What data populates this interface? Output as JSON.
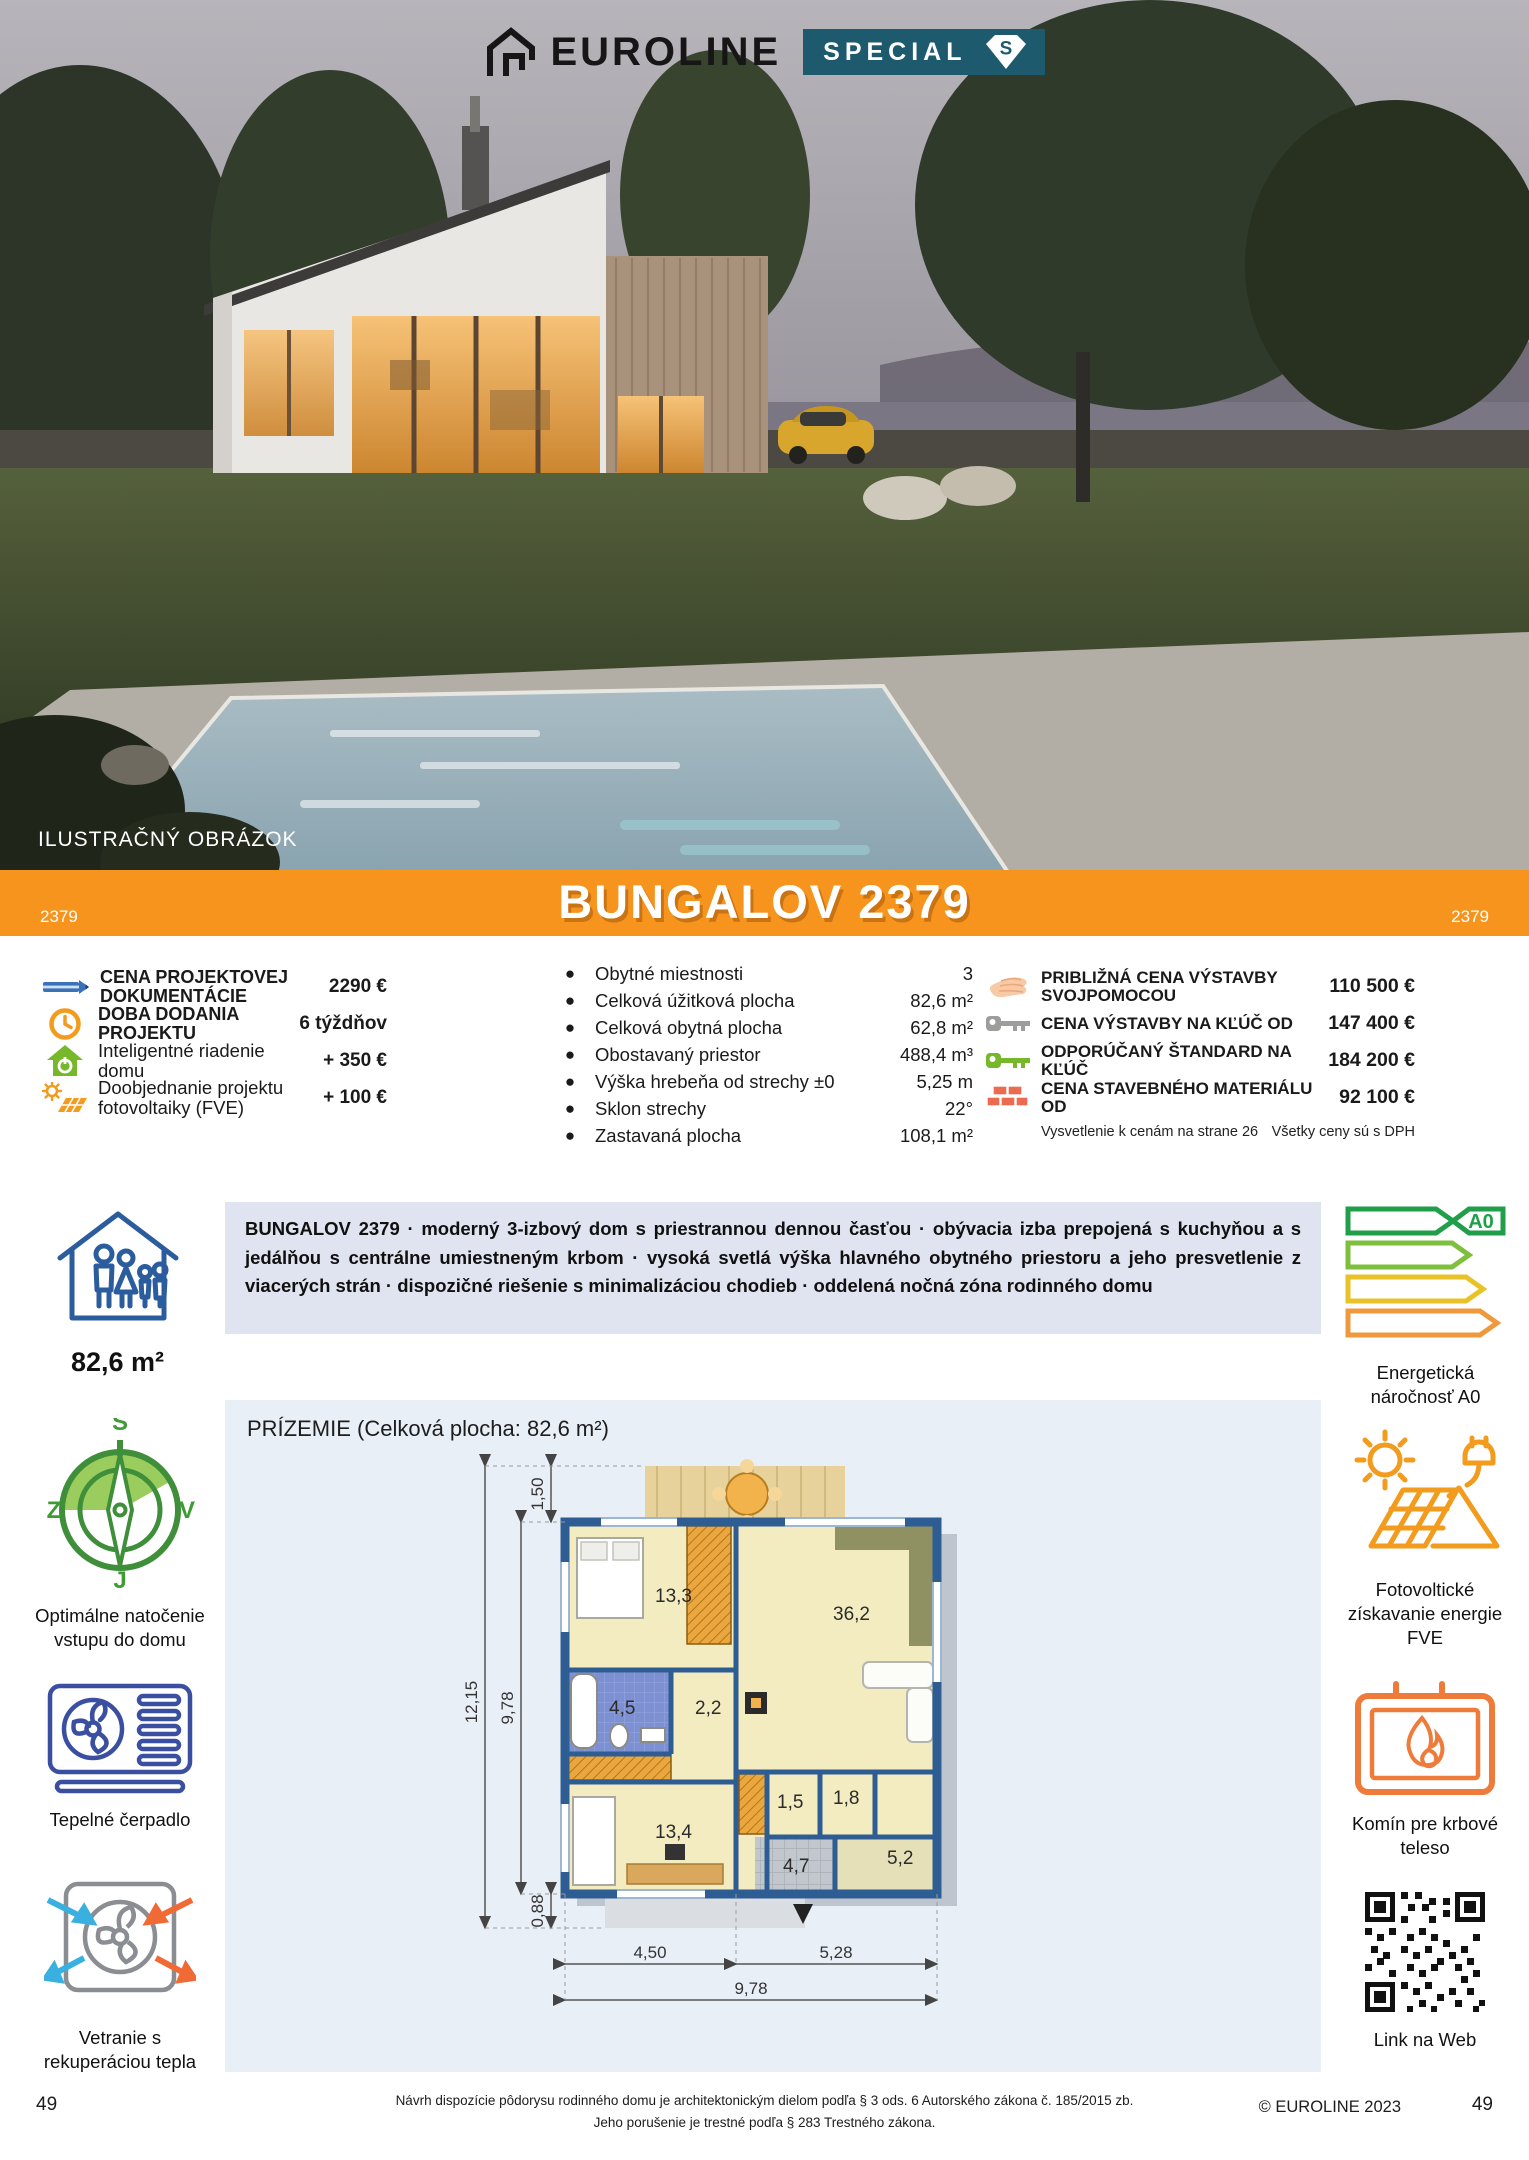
{
  "colors": {
    "accent_orange": "#f7941e",
    "badge_teal": "#1d5a6e",
    "desc_bg": "#dfe4f0",
    "plan_bg": "#e9eff7",
    "icon_blue": "#2b5d9e",
    "icon_green": "#76b82a"
  },
  "header": {
    "brand": "EUROLINE",
    "badge": "SPECIAL",
    "badge_monogram": "S",
    "photo_caption": "ILUSTRAČNÝ OBRÁZOK"
  },
  "banner": {
    "code_left": "2379",
    "title": "BUNGALOV 2379",
    "code_right": "2379"
  },
  "info": {
    "left": [
      {
        "icon": "pencil-icon",
        "label": "CENA PROJEKTOVEJ DOKUMENTÁCIE",
        "value": "2290 €"
      },
      {
        "icon": "clock-icon",
        "label": "DOBA DODANIA PROJEKTU",
        "value": "6 týždňov"
      },
      {
        "icon": "smart-home-icon",
        "label": "Inteligentné riadenie domu",
        "value": "+ 350 €"
      },
      {
        "icon": "solar-panel-icon",
        "label": "Doobjednanie projektu fotovoltaiky (FVE)",
        "value": "+ 100 €"
      }
    ],
    "params": [
      {
        "label": "Obytné miestnosti",
        "value": "3"
      },
      {
        "label": "Celková úžitková plocha",
        "value": "82,6 m²"
      },
      {
        "label": "Celková obytná plocha",
        "value": "62,8 m²"
      },
      {
        "label": "Obostavaný priestor",
        "value": "488,4 m³"
      },
      {
        "label": "Výška hrebeňa od strechy ±0",
        "value": "5,25 m"
      },
      {
        "label": "Sklon strechy",
        "value": "22°"
      },
      {
        "label": "Zastavaná plocha",
        "value": "108,1 m²"
      }
    ],
    "prices": [
      {
        "icon": "hand-icon",
        "label": "PRIBLIŽNÁ CENA VÝSTAVBY SVOJPOMOCOU",
        "value": "110 500 €"
      },
      {
        "icon": "key-gray-icon",
        "label": "CENA VÝSTAVBY NA KĽÚČ OD",
        "value": "147 400 €"
      },
      {
        "icon": "key-green-icon",
        "label": "ODPORÚČANÝ ŠTANDARD NA KĽÚČ",
        "value": "184 200 €"
      },
      {
        "icon": "bricks-icon",
        "label": "CENA STAVEBNÉHO MATERIÁLU OD",
        "value": "92 100 €"
      }
    ],
    "footnote_left": "Vysvetlenie k cenám na strane 26",
    "footnote_right": "Všetky ceny sú s DPH"
  },
  "summary": {
    "area": "82,6 m²",
    "description": "BUNGALOV 2379 · moderný 3-izbový dom s priestrannou dennou časťou · obývacia izba prepojená s kuchyňou a s jedálňou s centrálne umiestneným krbom · vysoká svetlá výška hlavného obytného priestoru a jeho presvetlenie z viacerých strán · dispozičné riešenie s minimalizáciou chodieb · oddelená nočná zóna rodinného domu",
    "energy_label": "A0",
    "energy_caption_line1": "Energetická",
    "energy_caption_line2": "náročnosť A0"
  },
  "features_left": [
    {
      "icon": "compass-icon",
      "caption": "Optimálne natočenie vstupu do domu",
      "compass": {
        "n": "S",
        "w": "Z",
        "e": "V",
        "s": "J"
      }
    },
    {
      "icon": "heat-pump-icon",
      "caption": "Tepelné čerpadlo"
    },
    {
      "icon": "ventilation-icon",
      "caption": "Vetranie s rekuperáciou tepla"
    }
  ],
  "features_right": [
    {
      "icon": "photovoltaic-icon",
      "caption": "Fotovoltické získavanie energie FVE"
    },
    {
      "icon": "fireplace-icon",
      "caption": "Komín pre krbové teleso"
    },
    {
      "icon": "qr-code",
      "caption": "Link na Web"
    }
  ],
  "floorplan": {
    "title": "PRÍZEMIE (Celková plocha: 82,6 m²)",
    "rooms": [
      "13,3",
      "36,2",
      "4,5",
      "2,2",
      "13,4",
      "1,5",
      "1,8",
      "4,7",
      "5,2"
    ],
    "dims": {
      "terrace_depth": "1,50",
      "left_total": "12,15",
      "left_inner": "9,78",
      "porch_depth": "0,88",
      "bottom_left": "4,50",
      "bottom_right": "5,28",
      "bottom_total": "9,78"
    }
  },
  "footer": {
    "page_left": "49",
    "legal_line1": "Návrh dispozície pôdorysu rodinného domu je architektonickým dielom podľa § 3 ods. 6 Autorského zákona č. 185/2015 zb.",
    "legal_line2": "Jeho porušenie je trestné podľa § 283 Trestného zákona.",
    "copyright": "© EUROLINE 2023",
    "page_right": "49"
  }
}
